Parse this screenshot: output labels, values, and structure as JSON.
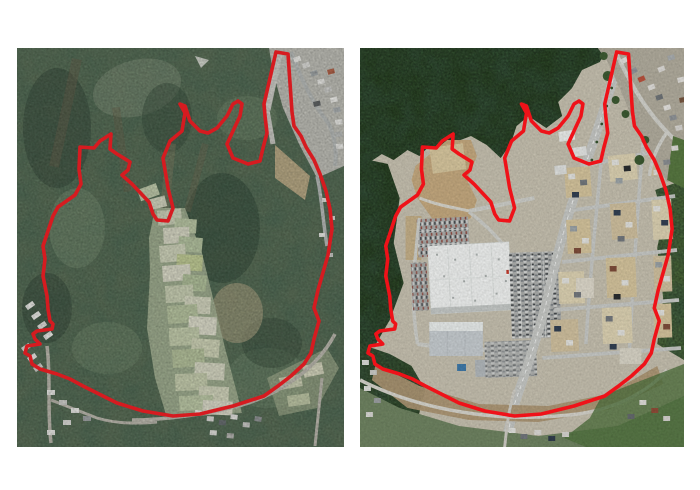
{
  "figure": {
    "background_color": "#ffffff",
    "panels": [
      {
        "id": "before",
        "position": "left",
        "description": "Aerial photograph of the site before development: forested hills, a central valley of small terraced fields, existing houses in the top-right corner and along the bottom roads; project boundary outlined in red."
      },
      {
        "id": "after",
        "position": "right",
        "description": "Aerial photograph of the same site after development: land cleared of forest, a large white commercial building with parking lots, a new main road and street grid with housing parcels; the same project boundary outlined in red."
      }
    ]
  },
  "annotation": {
    "boundary_color": "#e5151b",
    "boundary_stroke_width": 3.6,
    "boundary_points": [
      [
        259,
        4
      ],
      [
        271,
        6
      ],
      [
        275,
        64
      ],
      [
        277,
        78
      ],
      [
        284,
        88
      ],
      [
        289,
        99
      ],
      [
        297,
        112
      ],
      [
        303,
        126
      ],
      [
        309,
        143
      ],
      [
        313,
        161
      ],
      [
        315,
        181
      ],
      [
        311,
        207
      ],
      [
        305,
        228
      ],
      [
        301,
        242
      ],
      [
        297,
        260
      ],
      [
        302,
        273
      ],
      [
        297,
        291
      ],
      [
        294,
        305
      ],
      [
        287,
        316
      ],
      [
        274,
        328
      ],
      [
        261,
        338
      ],
      [
        247,
        348
      ],
      [
        216,
        358
      ],
      [
        183,
        366
      ],
      [
        156,
        368
      ],
      [
        126,
        363
      ],
      [
        100,
        355
      ],
      [
        80,
        345
      ],
      [
        66,
        338
      ],
      [
        53,
        331
      ],
      [
        40,
        326
      ],
      [
        23,
        321
      ],
      [
        15,
        316
      ],
      [
        13,
        308
      ],
      [
        8,
        305
      ],
      [
        10,
        298
      ],
      [
        23,
        296
      ],
      [
        18,
        291
      ],
      [
        16,
        286
      ],
      [
        20,
        283
      ],
      [
        35,
        281
      ],
      [
        36,
        276
      ],
      [
        33,
        273
      ],
      [
        31,
        261
      ],
      [
        30,
        248
      ],
      [
        26,
        228
      ],
      [
        28,
        211
      ],
      [
        26,
        198
      ],
      [
        30,
        186
      ],
      [
        36,
        168
      ],
      [
        41,
        159
      ],
      [
        58,
        147
      ],
      [
        64,
        136
      ],
      [
        62,
        121
      ],
      [
        63,
        99
      ],
      [
        77,
        100
      ],
      [
        83,
        93
      ],
      [
        94,
        86
      ],
      [
        93,
        101
      ],
      [
        100,
        106
      ],
      [
        113,
        114
      ],
      [
        111,
        122
      ],
      [
        105,
        127
      ],
      [
        115,
        136
      ],
      [
        132,
        154
      ],
      [
        136,
        166
      ],
      [
        140,
        172
      ],
      [
        151,
        173
      ],
      [
        156,
        160
      ],
      [
        151,
        140
      ],
      [
        146,
        110
      ],
      [
        153,
        93
      ],
      [
        165,
        83
      ],
      [
        168,
        65
      ],
      [
        163,
        56
      ],
      [
        168,
        58
      ],
      [
        173,
        73
      ],
      [
        183,
        83
      ],
      [
        191,
        85
      ],
      [
        200,
        80
      ],
      [
        210,
        68
      ],
      [
        216,
        56
      ],
      [
        221,
        53
      ],
      [
        225,
        56
      ],
      [
        223,
        68
      ],
      [
        216,
        83
      ],
      [
        210,
        96
      ],
      [
        216,
        110
      ],
      [
        231,
        116
      ],
      [
        243,
        113
      ],
      [
        246,
        100
      ],
      [
        250,
        85
      ],
      [
        248,
        68
      ],
      [
        247,
        56
      ]
    ]
  },
  "palette": {
    "forest_green_muted": "#51684d",
    "forest_green_dark": "#2f4d28",
    "field_pale": "#ccd1b5",
    "cleared_earth": "#c3a87f",
    "asphalt": "#aeb0ae",
    "store_roof": "#f0f2f1",
    "road_gray": "#c7c9c6"
  }
}
